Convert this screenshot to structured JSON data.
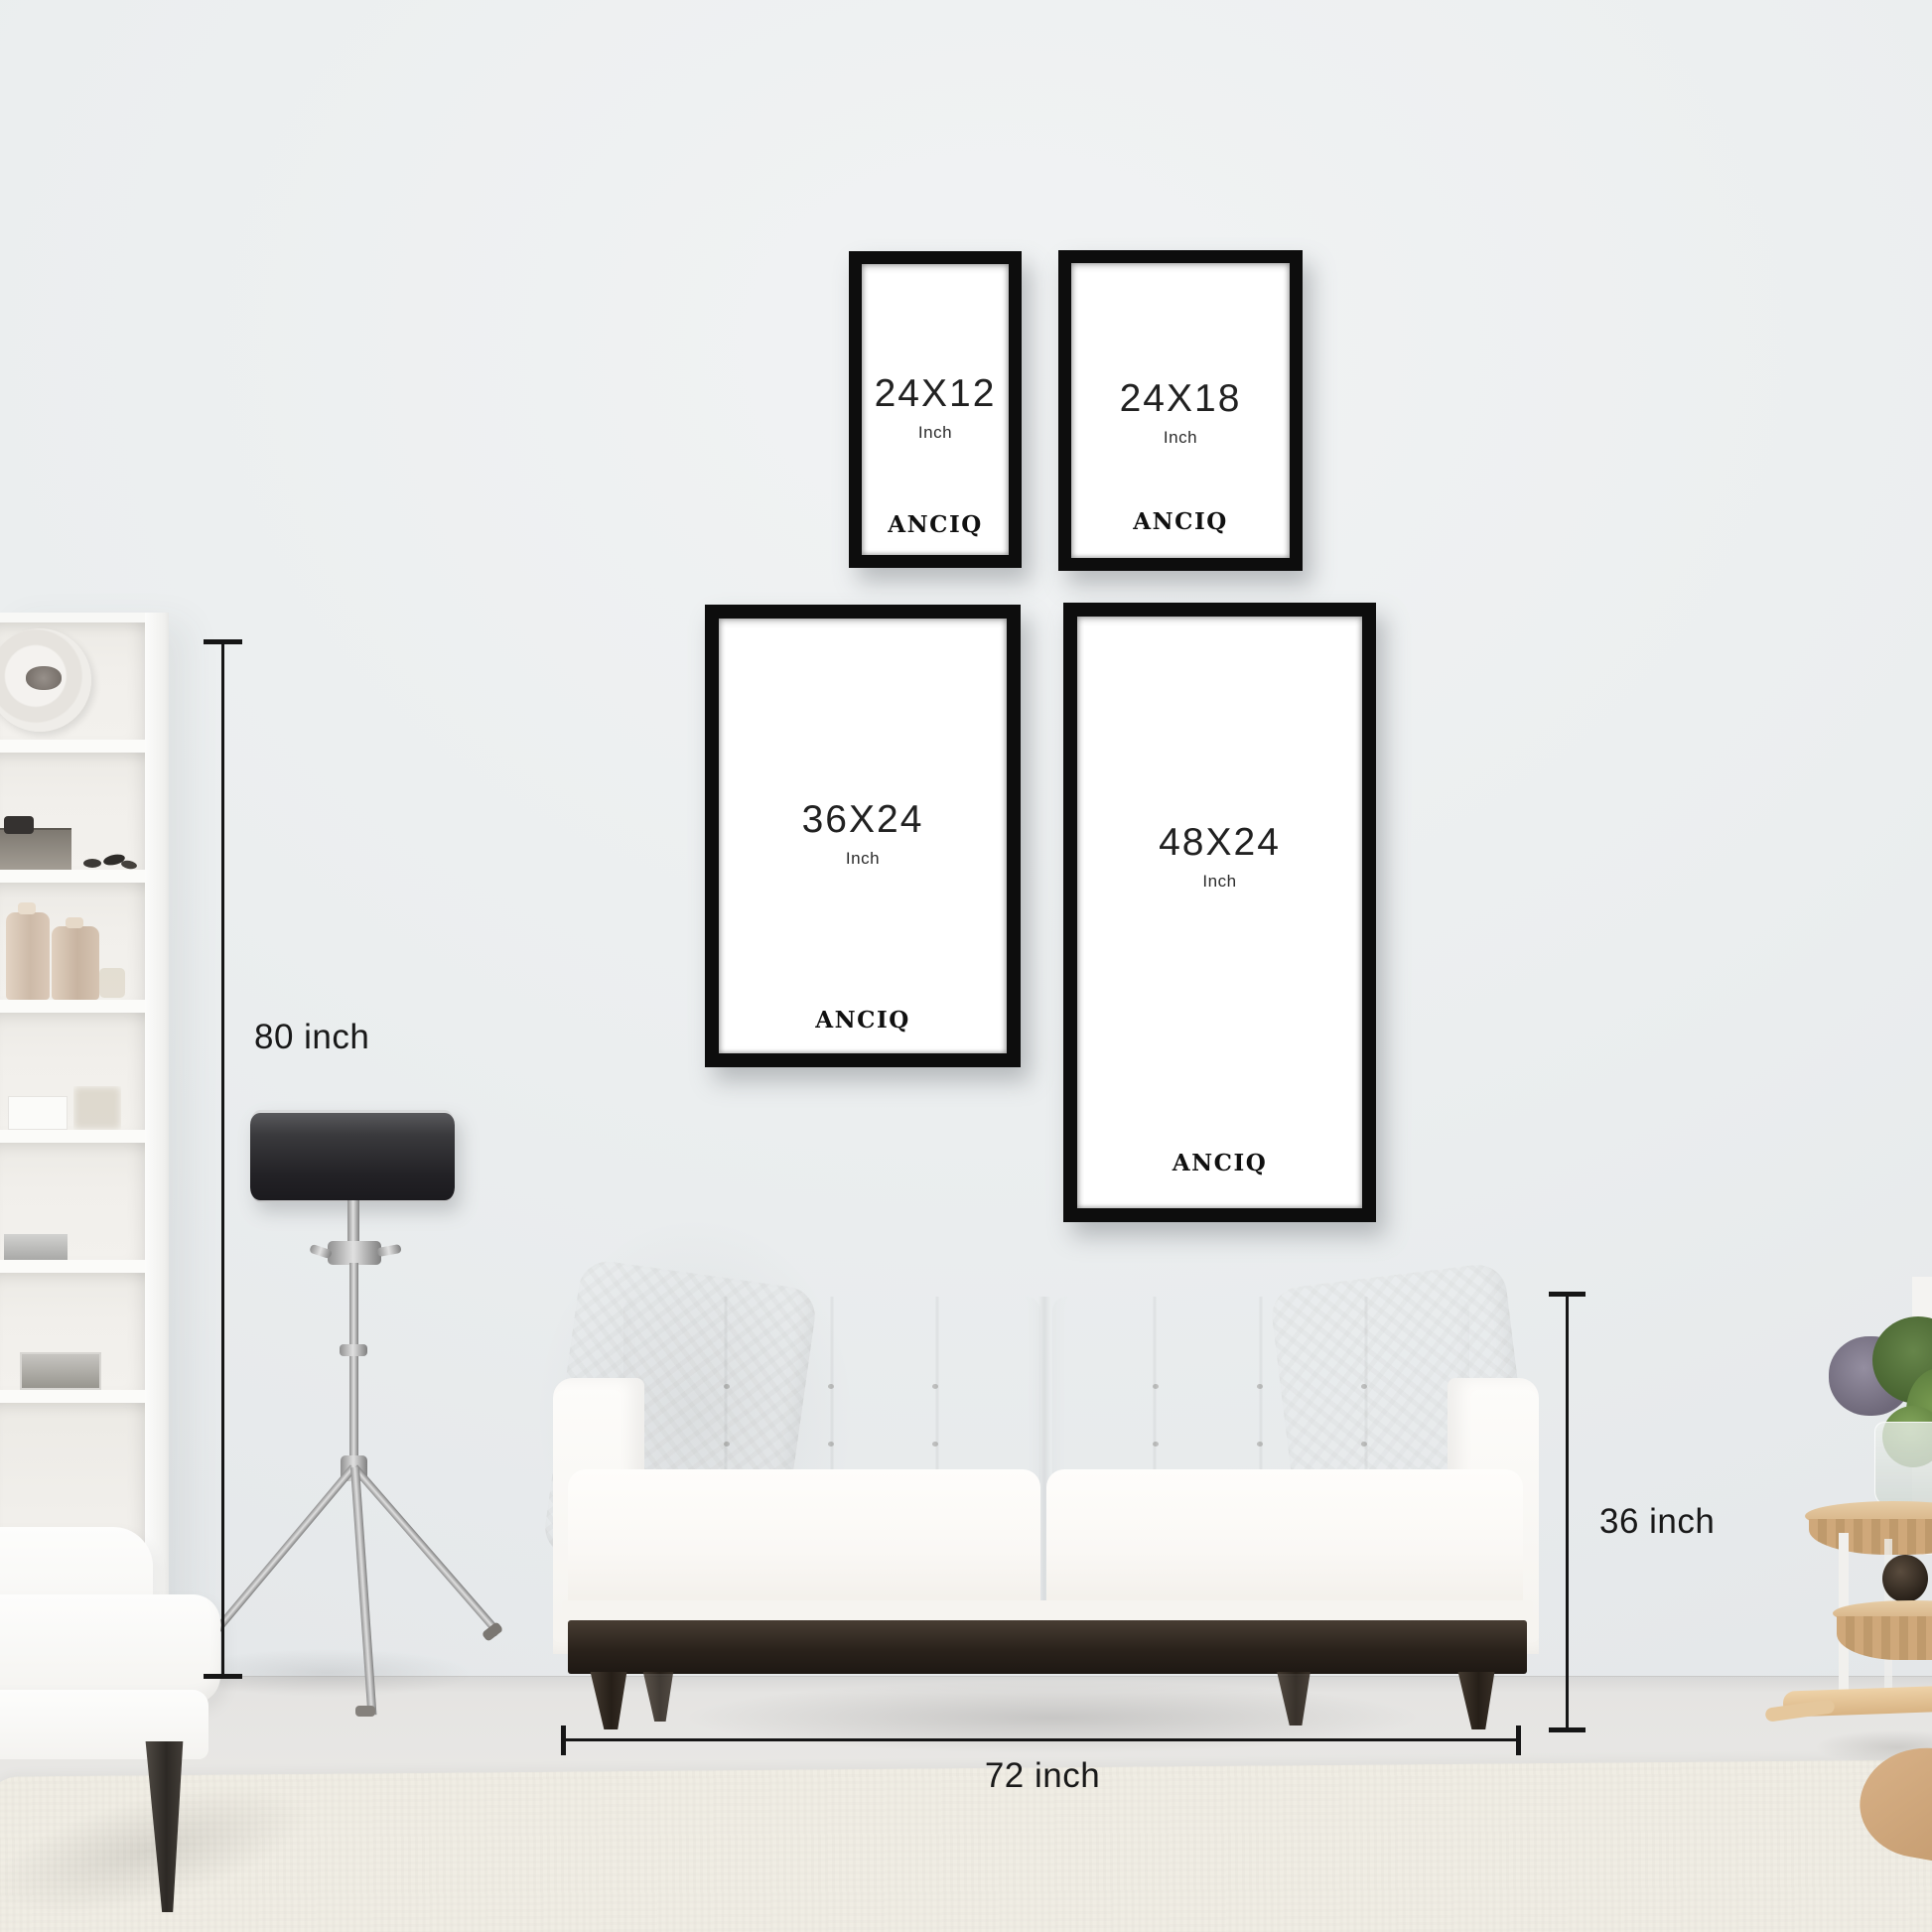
{
  "brand": "ANCIQ",
  "frames": [
    {
      "size": "24X12",
      "unit": "Inch",
      "brand": "ANCIQ"
    },
    {
      "size": "24X18",
      "unit": "Inch",
      "brand": "ANCIQ"
    },
    {
      "size": "36X24",
      "unit": "Inch",
      "brand": "ANCIQ"
    },
    {
      "size": "48X24",
      "unit": "Inch",
      "brand": "ANCIQ"
    }
  ],
  "measurements": {
    "wall_height": "80 inch",
    "sofa_height": "36 inch",
    "sofa_width": "72 inch"
  },
  "colors": {
    "frame_black": "#0d0d0d",
    "wall": "#eaedee",
    "floor": "#eae9e6",
    "rug": "#f0ede4",
    "annotation_text": "#191919",
    "lamp_shade": "#232226",
    "sofa_fabric": "#faf8f5",
    "sofa_wood_base": "#2a221b",
    "stool_wood": "#d7b488",
    "foliage_green": "#5d7b42",
    "bloom_purple": "#8e8899"
  }
}
